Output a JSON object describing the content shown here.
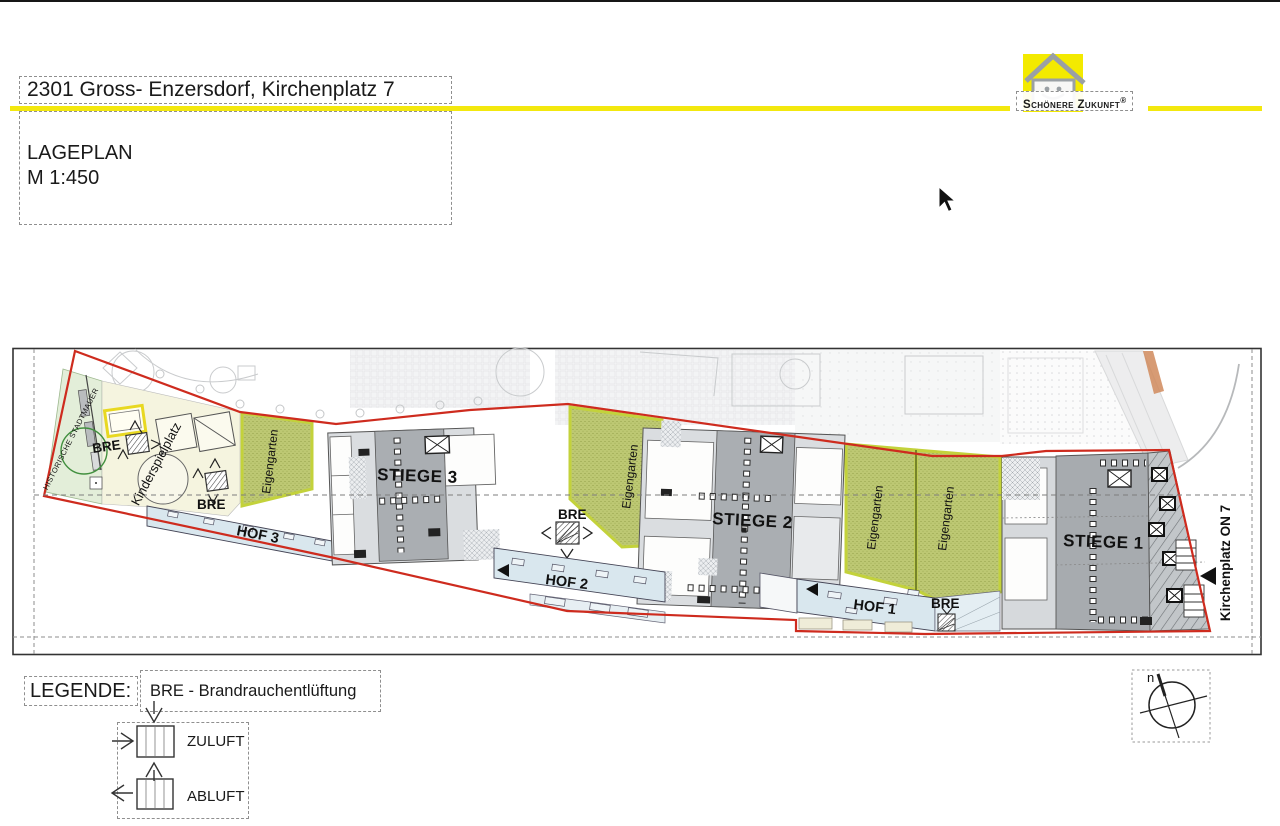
{
  "header": {
    "title": "2301 Gross- Enzersdorf, Kirchenplatz 7",
    "plan_type": "LAGEPLAN",
    "scale": "M 1:450"
  },
  "logo": {
    "brand": "Schönere Zukunft",
    "registered_mark": "®"
  },
  "site_plan": {
    "stairs": {
      "stiege1": "STIEGE 1",
      "stiege2": "STIEGE 2",
      "stiege3": "STIEGE 3"
    },
    "courtyards": {
      "hof1": "HOF 1",
      "hof2": "HOF 2",
      "hof3": "HOF 3"
    },
    "garden_label": "Eigengarten",
    "playground_label": "Kinderspielplatz",
    "historic_wall_label": "HISTORISCHE STADTMAUER",
    "street_label": "Kirchenplatz ON 7",
    "bre_label": "BRE"
  },
  "legend": {
    "heading": "LEGENDE:",
    "bre_definition": "BRE - Brandrauchentlüftung",
    "supply_air": "ZULUFT",
    "exhaust_air": "ABLUFT"
  },
  "compass": {
    "north_label": "n"
  },
  "colors": {
    "accent_yellow": "#f3e80e",
    "boundary_red": "#ce2b1e",
    "garden_green": "#bdc873",
    "courtyard_blue": "#d9e7ee",
    "building_gray": "#aaaeb2"
  }
}
